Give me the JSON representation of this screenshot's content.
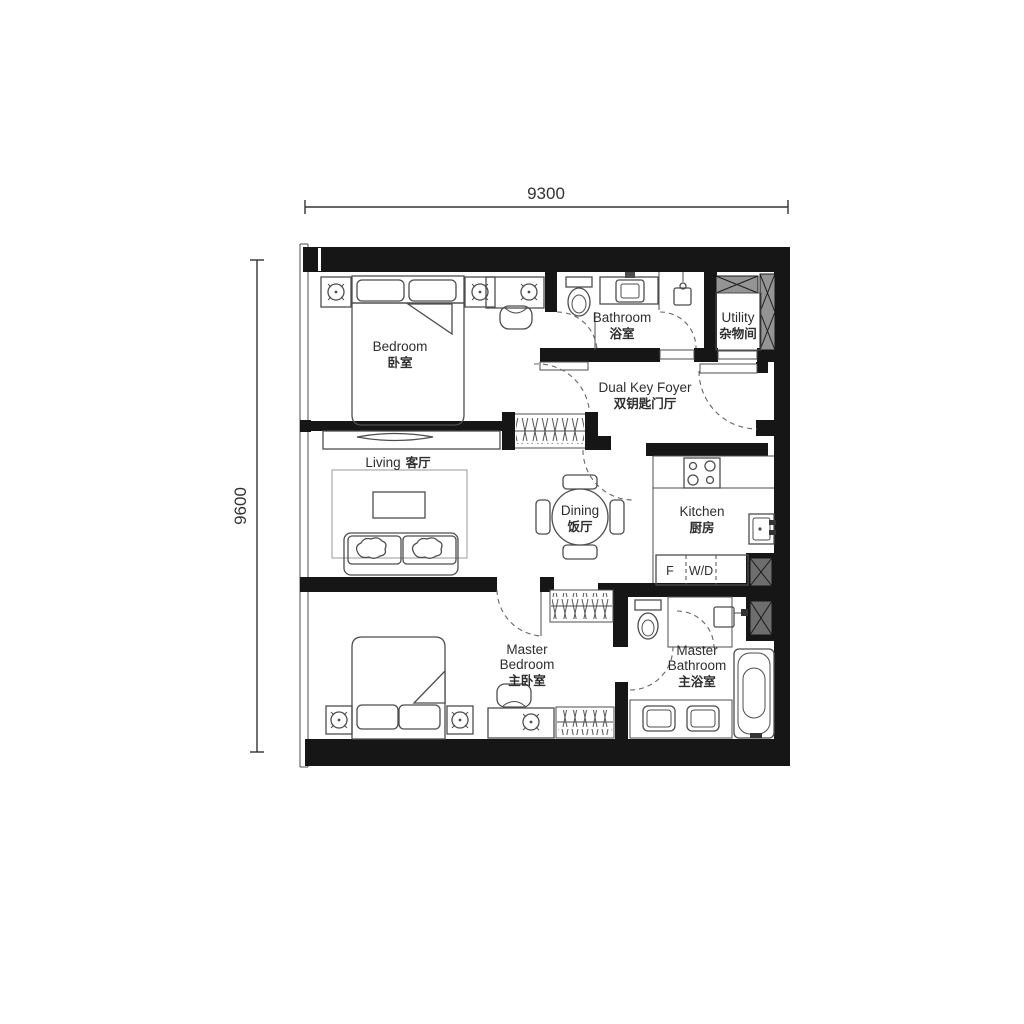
{
  "plan": {
    "dimensions": {
      "width_label": "9300",
      "height_label": "9600"
    },
    "rooms": {
      "bedroom": {
        "en": "Bedroom",
        "zh": "卧室"
      },
      "bathroom": {
        "en": "Bathroom",
        "zh": "浴室"
      },
      "utility": {
        "en": "Utility",
        "zh": "杂物间"
      },
      "foyer": {
        "en": "Dual Key Foyer",
        "zh": "双钥匙门厅"
      },
      "living": {
        "en": "Living",
        "zh": "客厅"
      },
      "dining": {
        "en": "Dining",
        "zh": "饭厅"
      },
      "kitchen": {
        "en": "Kitchen",
        "zh": "厨房"
      },
      "master_bedroom": {
        "en1": "Master",
        "en2": "Bedroom",
        "zh": "主卧室"
      },
      "master_bathroom": {
        "en1": "Master",
        "en2": "Bathroom",
        "zh": "主浴室"
      }
    },
    "appliances": {
      "fridge": "F",
      "washer_dryer": "W/D"
    },
    "colors": {
      "wall": "#161616",
      "line": "#4d4d4d",
      "text": "#2e2e2e",
      "shaft": "#949494",
      "shaft_dark": "#6e6e6e"
    }
  }
}
